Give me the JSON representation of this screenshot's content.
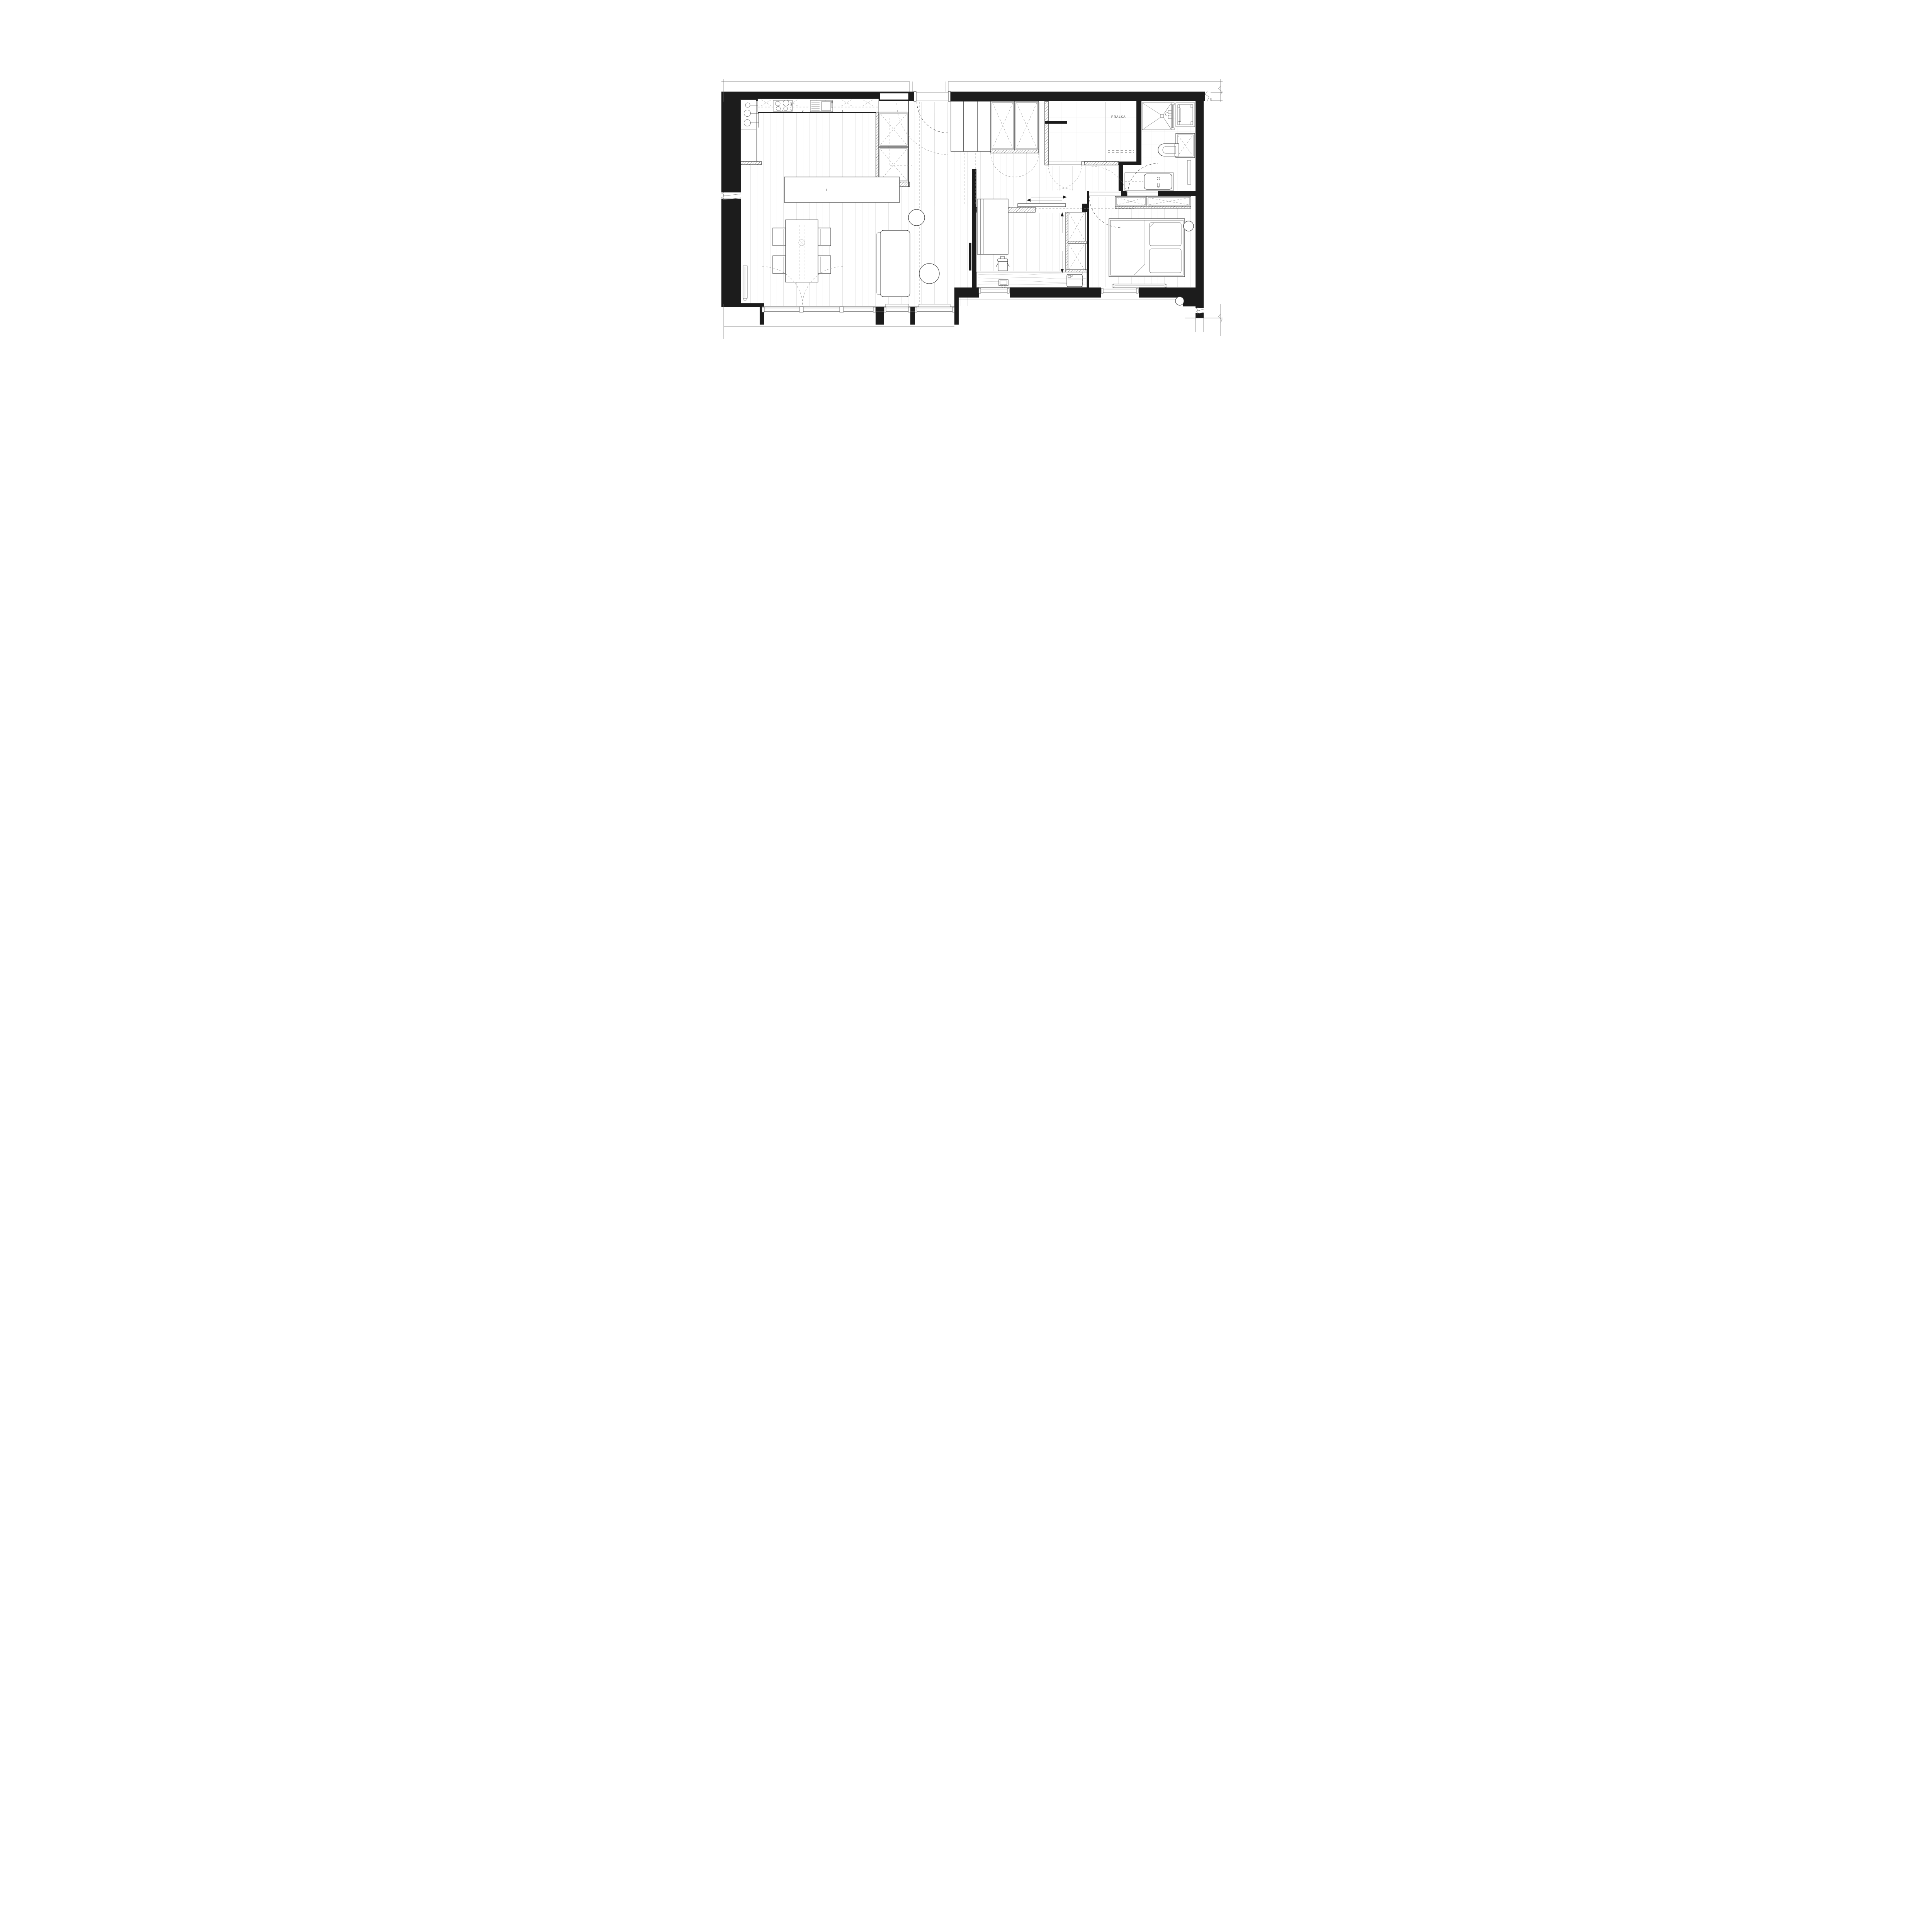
{
  "drawing_labels": {
    "utility": "PRALKA",
    "cooktop": "P",
    "sink": "Z",
    "counter": "L",
    "island": "L"
  },
  "colors": {
    "ink": "#1c1c1c",
    "medium_line": "#3c3c3c",
    "thin_line": "#6b6b6b",
    "dash_line": "#4a4a4a",
    "floor_plank": "#e4e4e4",
    "tile_grid": "#ececec",
    "wood_grain": "#c9c9c9",
    "background": "#ffffff"
  }
}
